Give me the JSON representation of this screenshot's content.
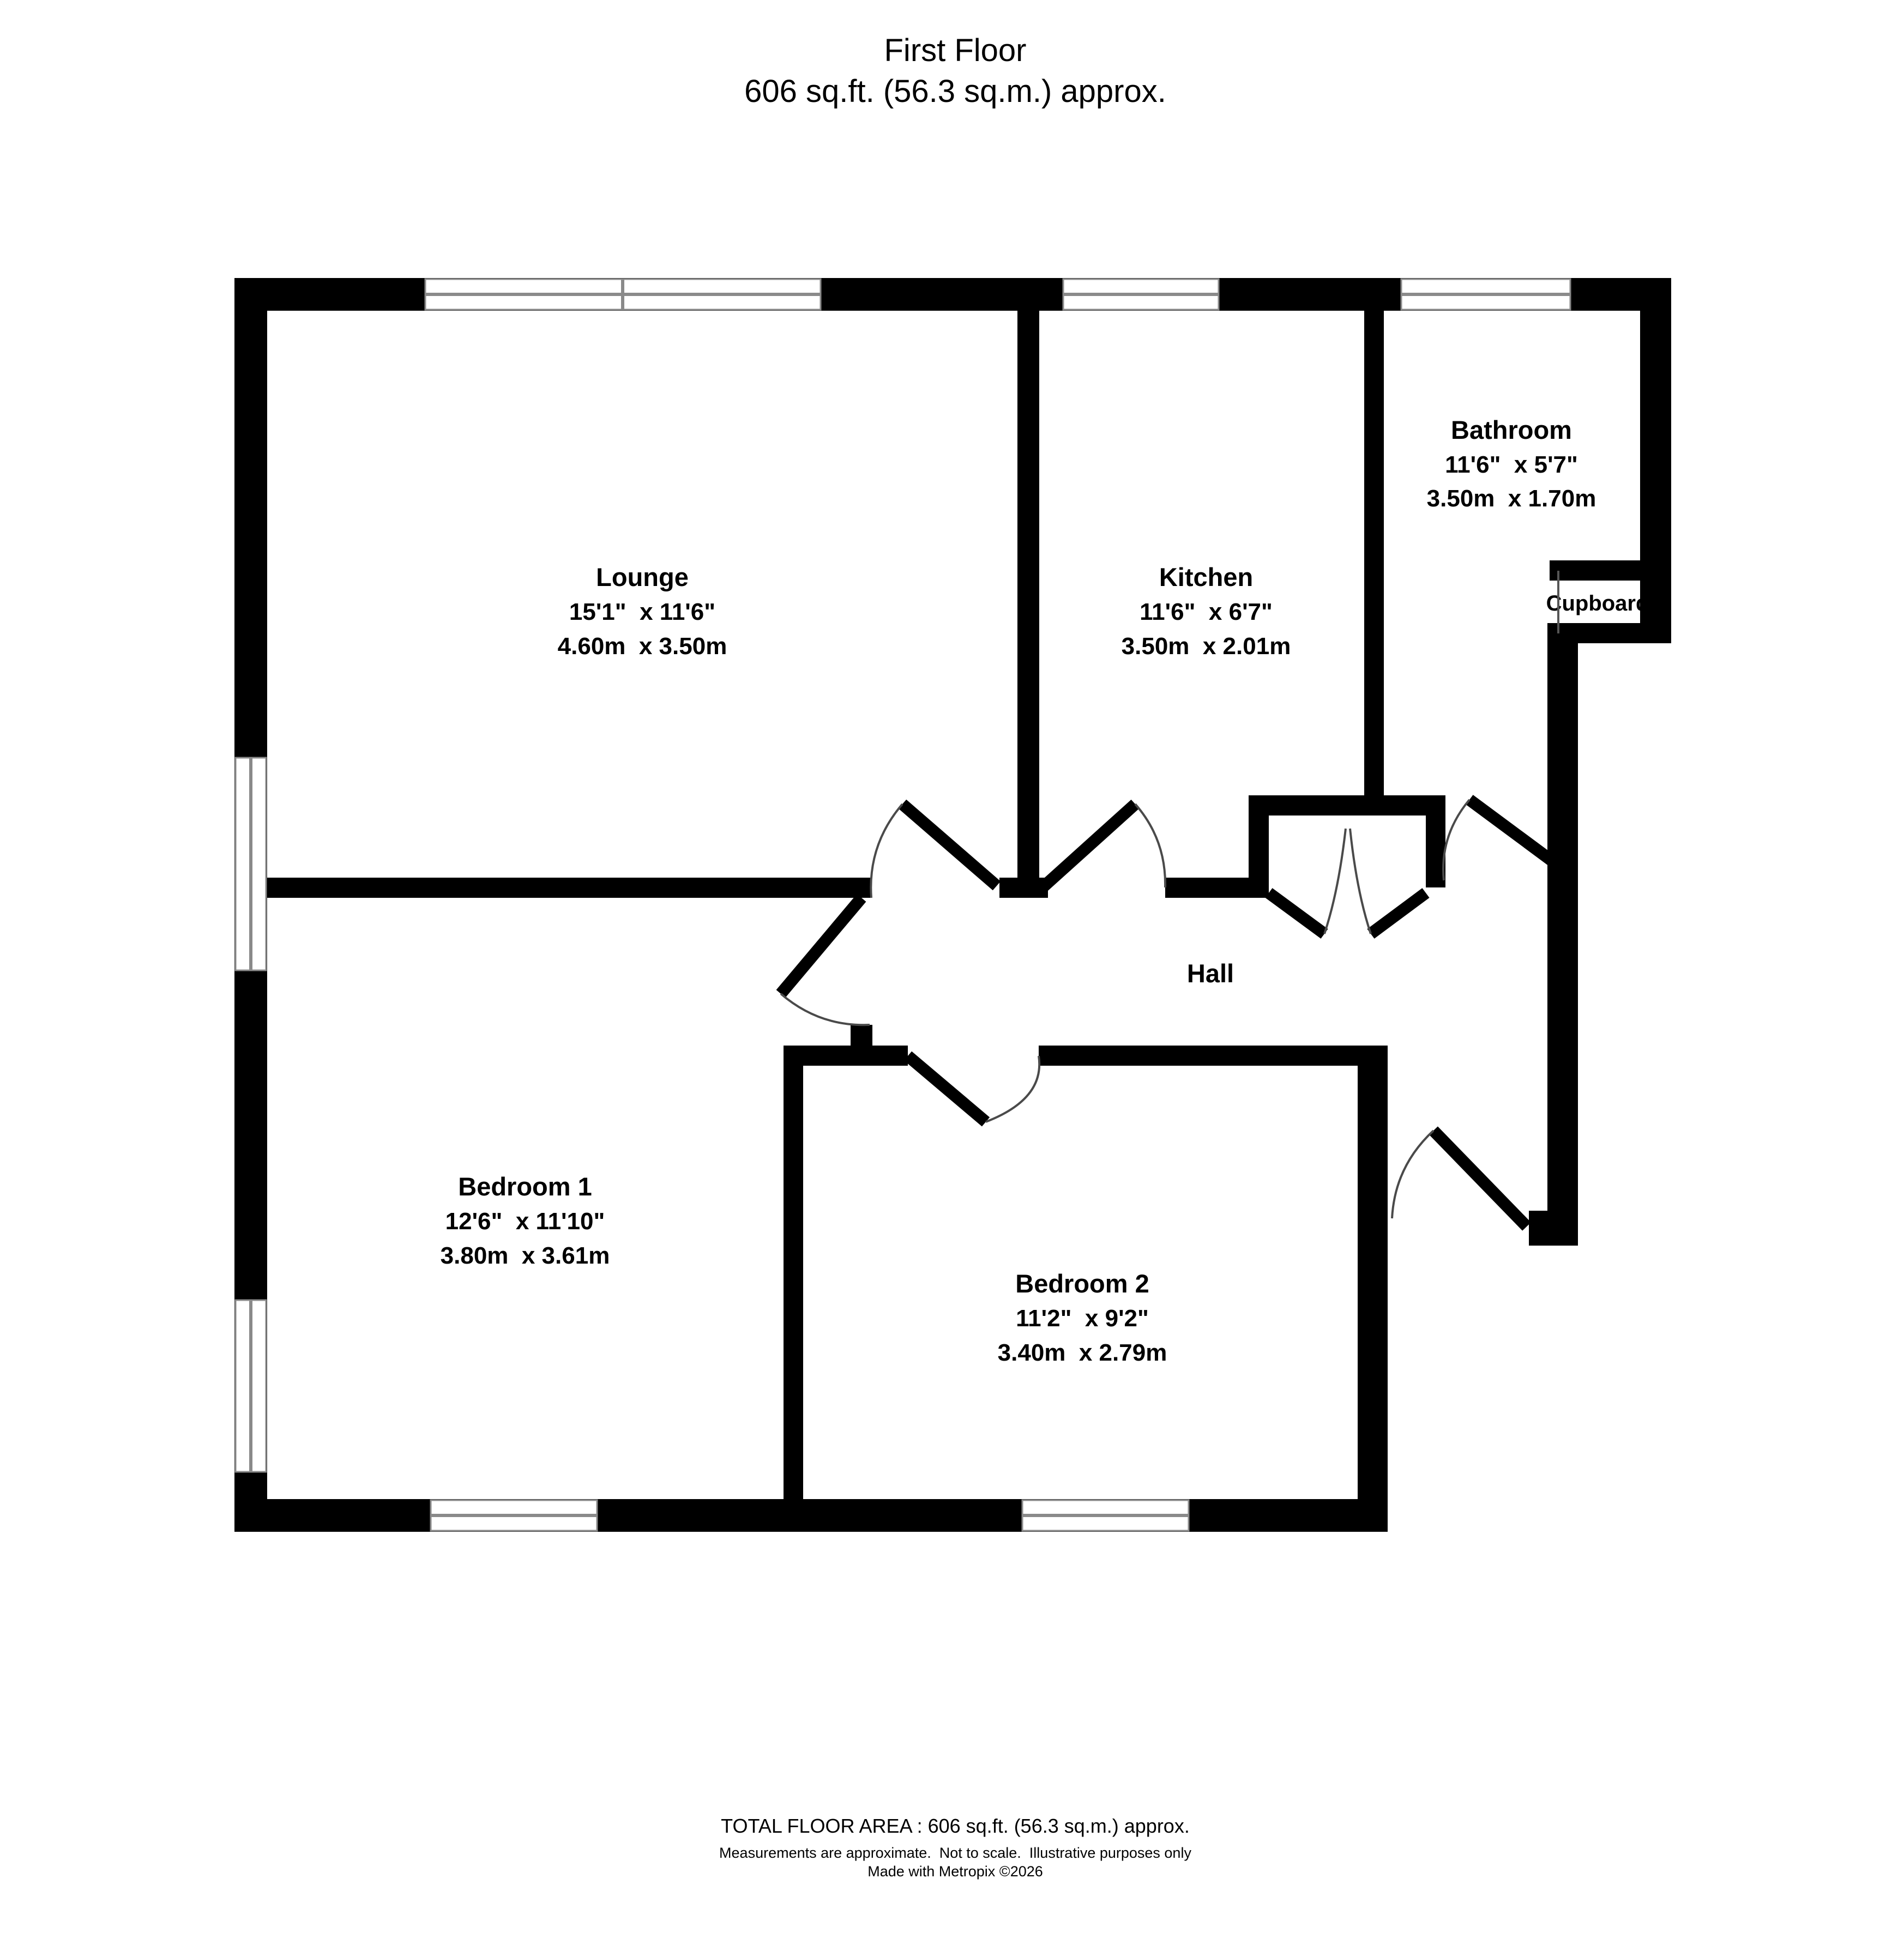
{
  "title": {
    "line1": "First Floor",
    "line2": "606 sq.ft. (56.3 sq.m.) approx."
  },
  "rooms": {
    "lounge": {
      "name": "Lounge",
      "imperial": "15'1\"  x 11'6\"",
      "metric": "4.60m  x 3.50m"
    },
    "kitchen": {
      "name": "Kitchen",
      "imperial": "11'6\"  x 6'7\"",
      "metric": "3.50m  x 2.01m"
    },
    "bathroom": {
      "name": "Bathroom",
      "imperial": "11'6\"  x 5'7\"",
      "metric": "3.50m  x 1.70m"
    },
    "bedroom1": {
      "name": "Bedroom 1",
      "imperial": "12'6\"  x 11'10\"",
      "metric": "3.80m  x 3.61m"
    },
    "bedroom2": {
      "name": "Bedroom 2",
      "imperial": "11'2\"  x 9'2\"",
      "metric": "3.40m  x 2.79m"
    },
    "hall": {
      "name": "Hall"
    },
    "cupboard": {
      "name": "Cupboard"
    }
  },
  "footer": {
    "line1": "TOTAL FLOOR AREA : 606 sq.ft. (56.3 sq.m.) approx.",
    "line2": "Measurements are approximate.  Not to scale.  Illustrative purposes only",
    "line3": "Made with Metropix ©2026"
  },
  "colors": {
    "wall": "#000000",
    "background": "#ffffff",
    "window_frame": "#8a8a8a",
    "door_arc": "#4a4a4a"
  }
}
